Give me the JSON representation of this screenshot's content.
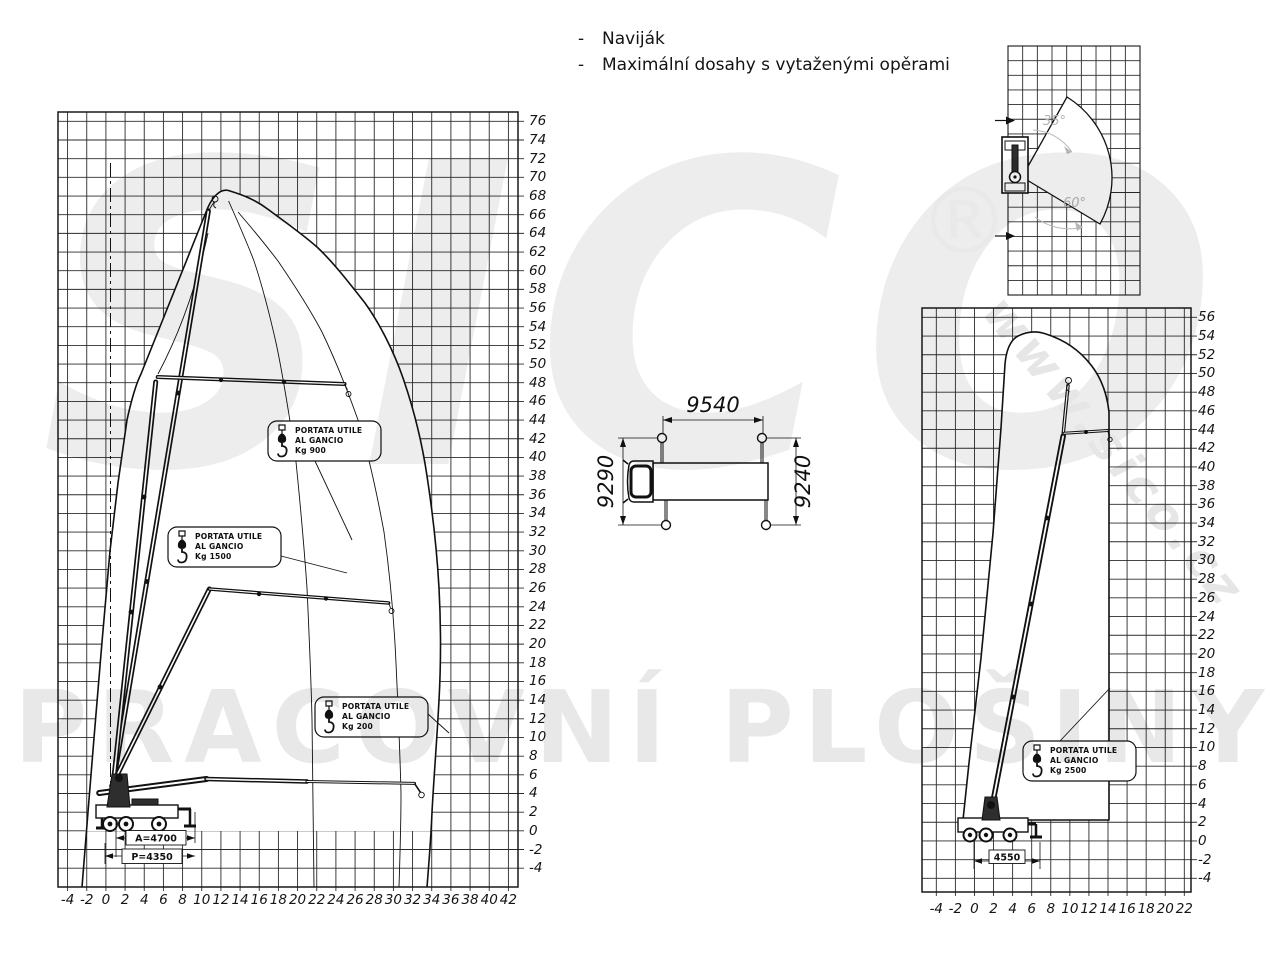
{
  "header": {
    "bullets": [
      {
        "dash": "-",
        "text": "Naviják"
      },
      {
        "dash": "-",
        "text": "Maximální dosahy s vytaženými opěrami"
      }
    ]
  },
  "watermark": {
    "logo": "SICO",
    "registered": "®",
    "url": "www.sico.cz",
    "bottom_text": "PRACOVNÍ PLOŠINY",
    "color": "#ececec"
  },
  "left_chart": {
    "x_ticks": [
      -4,
      -2,
      0,
      2,
      4,
      6,
      8,
      10,
      12,
      14,
      16,
      18,
      20,
      22,
      24,
      26,
      28,
      30,
      32,
      34,
      36,
      38,
      40,
      42
    ],
    "y_ticks": [
      76,
      74,
      72,
      70,
      68,
      66,
      64,
      62,
      60,
      58,
      56,
      54,
      52,
      50,
      48,
      46,
      44,
      42,
      40,
      38,
      36,
      34,
      32,
      30,
      28,
      26,
      24,
      22,
      20,
      18,
      16,
      14,
      12,
      10,
      8,
      6,
      4,
      2,
      0,
      -2,
      -4
    ],
    "capacity_labels": [
      {
        "line1": "PORTATA UTILE",
        "line2": "AL GANCIO",
        "line3": "Kg 900"
      },
      {
        "line1": "PORTATA UTILE",
        "line2": "AL GANCIO",
        "line3": "Kg 1500"
      },
      {
        "line1": "PORTATA UTILE",
        "line2": "AL GANCIO",
        "line3": "Kg 200"
      }
    ],
    "dimensions": {
      "a": "A=4700",
      "p": "P=4350"
    }
  },
  "right_chart": {
    "x_ticks": [
      -4,
      -2,
      0,
      2,
      4,
      6,
      8,
      10,
      12,
      14,
      16,
      18,
      20,
      22
    ],
    "y_ticks": [
      56,
      54,
      52,
      50,
      48,
      46,
      44,
      42,
      40,
      38,
      36,
      34,
      32,
      30,
      28,
      26,
      24,
      22,
      20,
      18,
      16,
      14,
      12,
      10,
      8,
      6,
      4,
      2,
      0,
      -2,
      -4
    ],
    "capacity_label": {
      "line1": "PORTATA UTILE",
      "line2": "AL GANCIO",
      "line3": "Kg 2500"
    },
    "dimension": "4550"
  },
  "top_view": {
    "angle_upper": "35°",
    "angle_lower": "60°"
  },
  "truck_top": {
    "dim_top": "9540",
    "dim_left": "9290",
    "dim_right": "9240"
  }
}
